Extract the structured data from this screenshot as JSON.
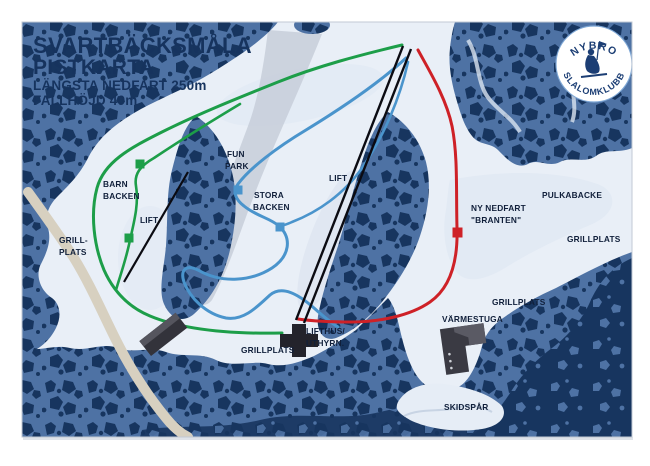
{
  "title": {
    "line1": "SVARTBÄCKSMÅLA",
    "line2": "PISTKARTA",
    "line3": "LÄNGSTA NEDFART 250m",
    "line4": "FALLHÖJD 40m"
  },
  "logo": {
    "top": "NYBRO",
    "bottom": "SLALOMKLUBB"
  },
  "labels": {
    "barn_backen_1": "BARN",
    "barn_backen_2": "BACKEN",
    "lift_left": "LIFT",
    "grill_left_1": "GRILL-",
    "grill_left_2": "PLATS",
    "fun_park_1": "FUN",
    "fun_park_2": "PARK",
    "stora_backen_1": "STORA",
    "stora_backen_2": "BACKEN",
    "lift_main": "LIFT",
    "ny_nedfart_1": "NY NEDFART",
    "ny_nedfart_2": "\"BRANTEN\"",
    "pulkabacke": "PULKABACKE",
    "grillplats_ne": "GRILLPLATS",
    "grillplats_e": "GRILLPLATS",
    "grillplats_s": "GRILLPLATS",
    "lifthus_1": "LIFTHUS/",
    "lifthus_2": "UTHYRN.",
    "varmestuga": "VÄRMESTUGA",
    "skidspar": "SKIDSPÅR"
  },
  "colors": {
    "snow": "#e9eff7",
    "forest": "#4e72a4",
    "tree_dark": "#17355f",
    "trail_easy_green": "#1d9e49",
    "trail_medium_blue": "#4a94cc",
    "trail_hard_red": "#ce2127",
    "lift_black": "#0b0b12",
    "road_tan": "#d7d0c0",
    "gray_slope": "#c7ced9",
    "building_dark": "#2e2e36",
    "label_text": "#101f3a",
    "title_text": "#16335e",
    "logo_navy": "#1c3e74"
  }
}
